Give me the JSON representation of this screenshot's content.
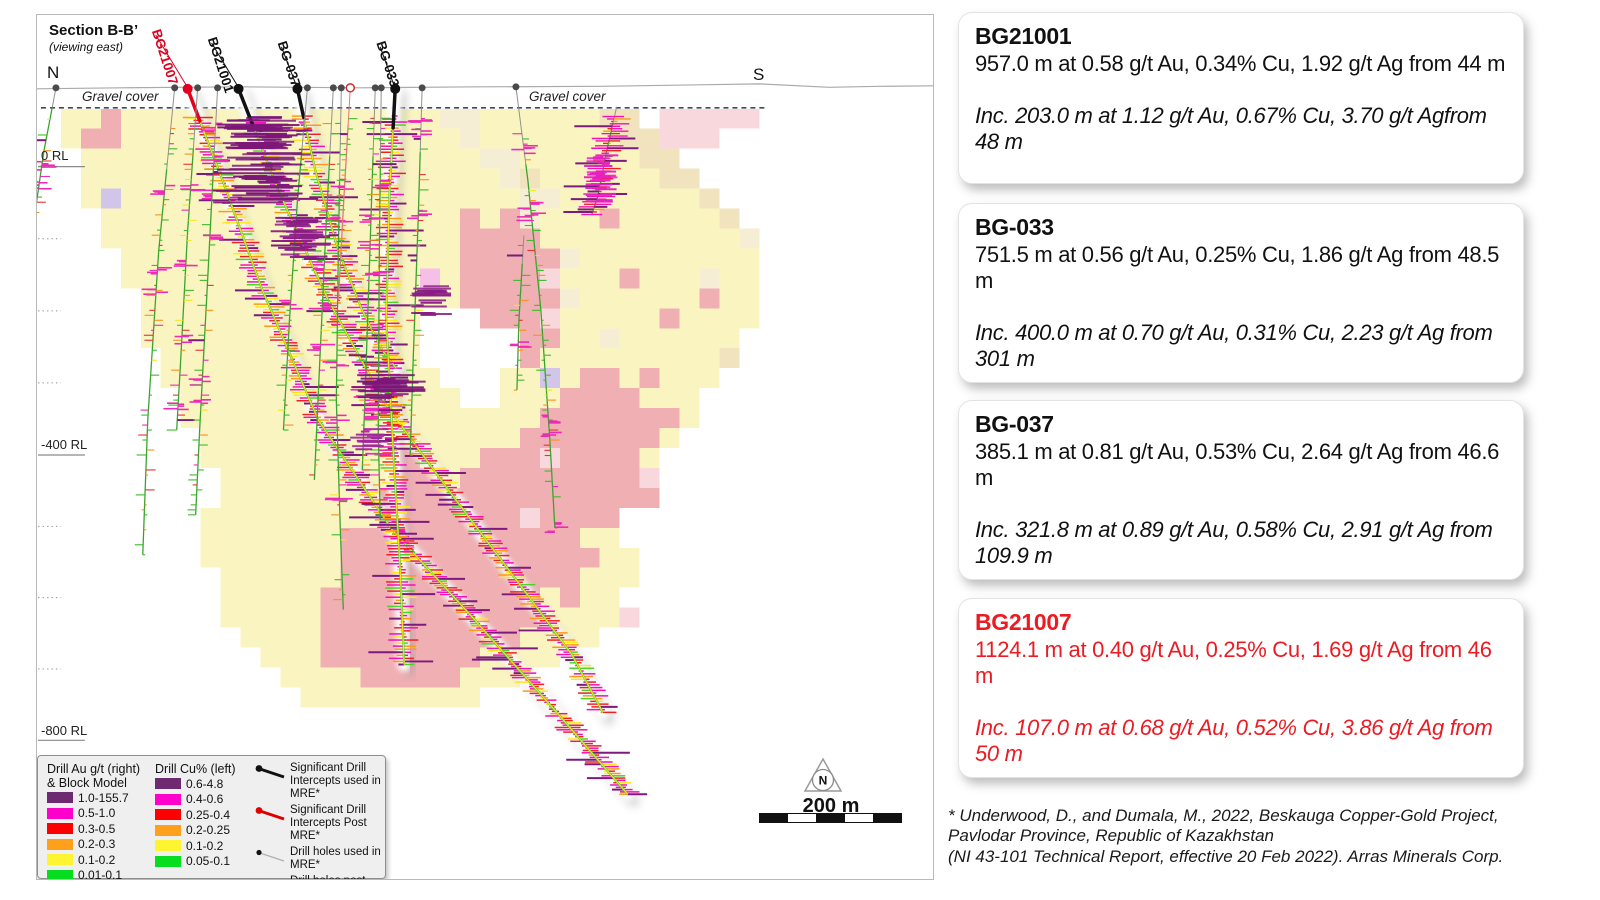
{
  "panel": {
    "title": "Section B-B’",
    "subtitle": "(viewing east)",
    "north_label": "N",
    "south_label": "S",
    "gravel_left": "Gravel cover",
    "gravel_right": "Gravel cover",
    "rl_labels": [
      {
        "text": "0 RL",
        "tick_y": 166
      },
      {
        "text": "-400 RL",
        "tick_y": 455
      },
      {
        "text": "-800 RL",
        "tick_y": 741
      }
    ],
    "surface_y": 87,
    "gravel_line": {
      "y": 107,
      "x1": 40,
      "x2": 768
    }
  },
  "blockmodel": {
    "origin_x": 40,
    "origin_y": 108,
    "cell": 20,
    "palette": {
      "y": "#faf4bd",
      "o": "#fdf9d8",
      "t": "#f4ecd2",
      "T": "#f0e2bb",
      "p": "#efabaf",
      "P": "#f8d6da",
      "m": "#f4bce6",
      "v": "#cfc2e9",
      "w": "#ffffff"
    },
    "rows": [
      ".yypyyyyyyyyyyyyyyyyttyyyyyyTT.PPPPP.",
      ".yppyyyyyyyyyyyyyyyyytyyyyyyyTTPPP...",
      "..yyyyyyyyyyyyyyyyyyyyttyyyyyyTT.....",
      "..yyyyyyyyyyyyyyyyyyyyytTyyyyyyTT....",
      "..yvyyyyyyyyyyyyyyyyyyyyttyyyyyyyT...",
      "...yyyyyyyyyyyyyyyyyypyptyyypyyyyyT..",
      "...yyyyyyyyyyyyyyyyyyppppyyyyyyyyyyt.",
      "....yyyyyyyyyyyyyyyyyppppptyyyyyyyyy.",
      "....yyyyyyyyyyyyyyymyppppPyyypyyytyy.",
      ".....yyyyyyyyyyyyyyyyppppptyyyyyypyy.",
      ".....yyyyyyyyyyyyyywwwpppPyyyyypyyyy.",
      ".....yyyyyyyyyyyyyywwwwwppyytyyyyyy..",
      "......yyyyyyyyyyyyywwwwwpyyyyyyyyyT..",
      "......yyyyyyyyyyyyyywwwyyvyppypyyy...",
      ".......yyyyyyyyyyyyyywwyyyppppyyy....",
      ".......yyyyyyyyyyyyyyyyyypppppppy....",
      "........yyyyyyyyyyyyyyyypppppppy.....",
      "........yyyyyyyyyypyyypppPppppy......",
      ".........yyyyyyyyyppypppppppppP......",
      ".........yyyyyyyypppppppppppppp......",
      "........yyyyyyyyypppppppPpppp........",
      "........yyyyyyyppppppppppppyy........",
      "........yyyyyyypppppppppppppyy.......",
      ".........yyyyyyppppppppppppyyy.......",
      ".........yyyyypppppppppppypyy........",
      ".........yyyyypppppppppppyyyyP.......",
      "..........yyyyppppppppppyyyy.........",
      "...........yyyppppppppyyyy...........",
      "............yyyypppppyyy.............",
      ".............yyyyyyyyy..............."
    ]
  },
  "drillholes": [
    {
      "name": "BG21007",
      "label": "BG21007",
      "label_color": "#e1001e",
      "significant": true,
      "collar": [
        187,
        88
      ],
      "label_pos": [
        151,
        30
      ],
      "seed": 11,
      "tick": "hot",
      "path": [
        [
          187,
          88
        ],
        [
          222,
          180
        ],
        [
          262,
          290
        ],
        [
          318,
          420
        ],
        [
          392,
          530
        ],
        [
          470,
          615
        ],
        [
          556,
          712
        ],
        [
          628,
          795
        ]
      ]
    },
    {
      "name": "BG21001",
      "label": "BG21001",
      "label_color": "#111111",
      "significant": true,
      "collar": [
        238,
        88
      ],
      "label_pos": [
        207,
        38
      ],
      "seed": 5,
      "tick": "hot",
      "path": [
        [
          238,
          88
        ],
        [
          278,
          190
        ],
        [
          328,
          300
        ],
        [
          386,
          405
        ],
        [
          452,
          495
        ],
        [
          520,
          585
        ],
        [
          572,
          655
        ],
        [
          603,
          713
        ]
      ]
    },
    {
      "name": "BG-037",
      "label": "BG-037",
      "label_color": "#111111",
      "significant": true,
      "collar": [
        297,
        88
      ],
      "label_pos": [
        277,
        42
      ],
      "seed": 8,
      "tick": "hot",
      "path": [
        [
          297,
          88
        ],
        [
          315,
          170
        ],
        [
          338,
          250
        ],
        [
          362,
          310
        ],
        [
          382,
          350
        ],
        [
          396,
          368
        ]
      ]
    },
    {
      "name": "BG-033",
      "label": "BG-033",
      "label_color": "#111111",
      "significant": true,
      "collar": [
        395,
        88
      ],
      "label_pos": [
        376,
        42
      ],
      "seed": 13,
      "tick": "hot",
      "path": [
        [
          395,
          88
        ],
        [
          389,
          200
        ],
        [
          386,
          320
        ],
        [
          393,
          450
        ],
        [
          400,
          570
        ],
        [
          404,
          665
        ]
      ]
    },
    {
      "name": "drillhole",
      "collar": [
        55,
        87
      ],
      "seed": 21,
      "tick": "cool",
      "path": [
        [
          55,
          87
        ],
        [
          43,
          150
        ],
        [
          34,
          212
        ]
      ]
    },
    {
      "name": "drillhole",
      "collar": [
        174,
        87
      ],
      "seed": 22,
      "tick": "cool",
      "path": [
        [
          174,
          87
        ],
        [
          158,
          250
        ],
        [
          147,
          420
        ],
        [
          142,
          555
        ]
      ]
    },
    {
      "name": "drillhole",
      "collar": [
        197,
        87
      ],
      "seed": 23,
      "tick": "cool",
      "path": [
        [
          197,
          87
        ],
        [
          187,
          230
        ],
        [
          180,
          360
        ],
        [
          176,
          430
        ]
      ]
    },
    {
      "name": "drillhole",
      "collar": [
        217,
        87
      ],
      "seed": 24,
      "tick": "cool",
      "path": [
        [
          217,
          87
        ],
        [
          207,
          280
        ],
        [
          199,
          430
        ],
        [
          195,
          515
        ]
      ]
    },
    {
      "name": "drillhole",
      "collar": [
        307,
        87
      ],
      "seed": 25,
      "tick": "cool",
      "path": [
        [
          307,
          87
        ],
        [
          297,
          200
        ],
        [
          289,
          320
        ],
        [
          283,
          430
        ]
      ]
    },
    {
      "name": "drillhole",
      "collar": [
        333,
        87
      ],
      "seed": 26,
      "tick": "cool",
      "path": [
        [
          333,
          87
        ],
        [
          326,
          220
        ],
        [
          319,
          370
        ],
        [
          314,
          480
        ]
      ]
    },
    {
      "name": "drillhole",
      "collar": [
        341,
        87
      ],
      "seed": 27,
      "tick": "cool",
      "path": [
        [
          341,
          87
        ],
        [
          338,
          250
        ],
        [
          336,
          400
        ],
        [
          340,
          530
        ],
        [
          343,
          610
        ]
      ]
    },
    {
      "name": "drillhole",
      "collar": [
        350,
        87
      ],
      "collar_style": "ring",
      "seed": 28,
      "tick": "cool",
      "line_color": "#e07a7a",
      "path": [
        [
          350,
          87
        ],
        [
          344,
          190
        ],
        [
          338,
          300
        ]
      ]
    },
    {
      "name": "drillhole",
      "collar": [
        375,
        87
      ],
      "seed": 29,
      "tick": "cool",
      "path": [
        [
          375,
          87
        ],
        [
          370,
          240
        ],
        [
          365,
          390
        ],
        [
          362,
          470
        ]
      ]
    },
    {
      "name": "drillhole",
      "collar": [
        381,
        87
      ],
      "seed": 30,
      "tick": "cool",
      "path": [
        [
          381,
          87
        ],
        [
          379,
          260
        ],
        [
          378,
          430
        ],
        [
          380,
          520
        ]
      ]
    },
    {
      "name": "drillhole",
      "collar": [
        422,
        87
      ],
      "seed": 31,
      "tick": "cool",
      "path": [
        [
          422,
          87
        ],
        [
          418,
          220
        ],
        [
          413,
          360
        ],
        [
          410,
          455
        ]
      ]
    },
    {
      "name": "drillhole",
      "collar": [
        516,
        86
      ],
      "seed": 32,
      "tick": "cool",
      "path": [
        [
          516,
          86
        ],
        [
          528,
          180
        ],
        [
          541,
          310
        ],
        [
          550,
          440
        ],
        [
          555,
          528
        ]
      ]
    },
    {
      "name": "drillhole",
      "collar": null,
      "seed": 33,
      "tick": "cool",
      "path": [
        [
          524,
          235
        ],
        [
          519,
          320
        ],
        [
          517,
          390
        ]
      ]
    },
    {
      "name": "drillhole",
      "collar": null,
      "seed": 34,
      "tick": "mag",
      "path": [
        [
          617,
          106
        ],
        [
          607,
          150
        ],
        [
          598,
          196
        ],
        [
          592,
          214
        ]
      ]
    }
  ],
  "blobs": [
    {
      "x": 263,
      "y": 158,
      "w": 72,
      "h": 88,
      "color": "#7c1679",
      "n": 70
    },
    {
      "x": 300,
      "y": 237,
      "w": 46,
      "h": 40,
      "color": "#8b1d86",
      "n": 30
    },
    {
      "x": 390,
      "y": 387,
      "w": 58,
      "h": 26,
      "color": "#7c1679",
      "n": 22
    },
    {
      "x": 432,
      "y": 300,
      "w": 40,
      "h": 30,
      "color": "#8b1d86",
      "n": 18
    },
    {
      "x": 372,
      "y": 440,
      "w": 34,
      "h": 22,
      "color": "#a426a0",
      "n": 14
    },
    {
      "x": 602,
      "y": 178,
      "w": 30,
      "h": 48,
      "color": "#e820c4",
      "n": 26
    }
  ],
  "legend": {
    "au_title1": "Drill Au g/t (right)",
    "au_title2": "& Block Model",
    "cu_title": "Drill Cu% (left)",
    "au_items": [
      {
        "range": "1.0-155.7",
        "color": "#6d2a70"
      },
      {
        "range": "0.5-1.0",
        "color": "#ff00cc"
      },
      {
        "range": "0.3-0.5",
        "color": "#fe0000"
      },
      {
        "range": "0.2-0.3",
        "color": "#ffa01c"
      },
      {
        "range": "0.1-0.2",
        "color": "#fff431"
      },
      {
        "range": "0.01-0.1",
        "color": "#05dd1e"
      }
    ],
    "cu_items": [
      {
        "range": "0.6-4.8",
        "color": "#6d2a70"
      },
      {
        "range": "0.4-0.6",
        "color": "#ff00cc"
      },
      {
        "range": "0.25-0.4",
        "color": "#fe0000"
      },
      {
        "range": "0.2-0.25",
        "color": "#ffa01c"
      },
      {
        "range": "0.1-0.2",
        "color": "#fff431"
      },
      {
        "range": "0.05-0.1",
        "color": "#05dd1e"
      }
    ],
    "symbols": [
      {
        "label": "Significant Drill Intercepts used in MRE*",
        "dot": "#111111",
        "line": "#111111",
        "thick": true
      },
      {
        "label": "Significant Drill Intercepts Post MRE*",
        "dot": "#e10000",
        "line": "#e10000",
        "thick": true
      },
      {
        "label": "Drill holes used in MRE*",
        "dot": "#111111",
        "line": "#b0b0b0",
        "thick": false
      },
      {
        "label": "Drill holes post MRE*",
        "dot": "#e10000",
        "line": "#e89090",
        "thick": false
      }
    ]
  },
  "compass": {
    "label": "N"
  },
  "scalebar": {
    "label": "200 m",
    "segments": [
      "#111111",
      "#ffffff",
      "#111111",
      "#ffffff",
      "#111111"
    ]
  },
  "callouts": [
    {
      "name": "BG21001",
      "color": "#111111",
      "main": "957.0 m at 0.58 g/t Au, 0.34% Cu, 1.92 g/t Ag from 44 m",
      "inc": "Inc. 203.0 m at 1.12 g/t Au, 0.67% Cu, 3.70 g/t Agfrom 48 m"
    },
    {
      "name": "BG-033",
      "color": "#111111",
      "main": "751.5 m at 0.56 g/t Au, 0.25% Cu, 1.86 g/t Ag from 48.5 m",
      "inc": "Inc. 400.0 m at 0.70 g/t Au, 0.31% Cu, 2.23 g/t Ag from 301 m"
    },
    {
      "name": "BG-037",
      "color": "#111111",
      "main": "385.1 m at 0.81 g/t Au, 0.53% Cu, 2.64 g/t Ag from 46.6 m",
      "inc": "Inc. 321.8 m at 0.89 g/t Au, 0.58% Cu, 2.91 g/t Ag from 109.9 m"
    },
    {
      "name": "BG21007",
      "color": "#ec1b23",
      "main": "1124.1 m at 0.40 g/t Au, 0.25% Cu, 1.69 g/t Ag from 46 m",
      "inc": "Inc. 107.0 m at 0.68 g/t Au, 0.52% Cu, 3.86 g/t Ag from 50 m"
    }
  ],
  "callout_tops": [
    12,
    203,
    400,
    598
  ],
  "footnote": [
    "* Underwood, D., and Dumala, M., 2022, Beskauga Copper-Gold Project,",
    "Pavlodar Province, Republic of Kazakhstan",
    "(NI 43-101 Technical Report, effective 20 Feb 2022). Arras Minerals Corp."
  ]
}
